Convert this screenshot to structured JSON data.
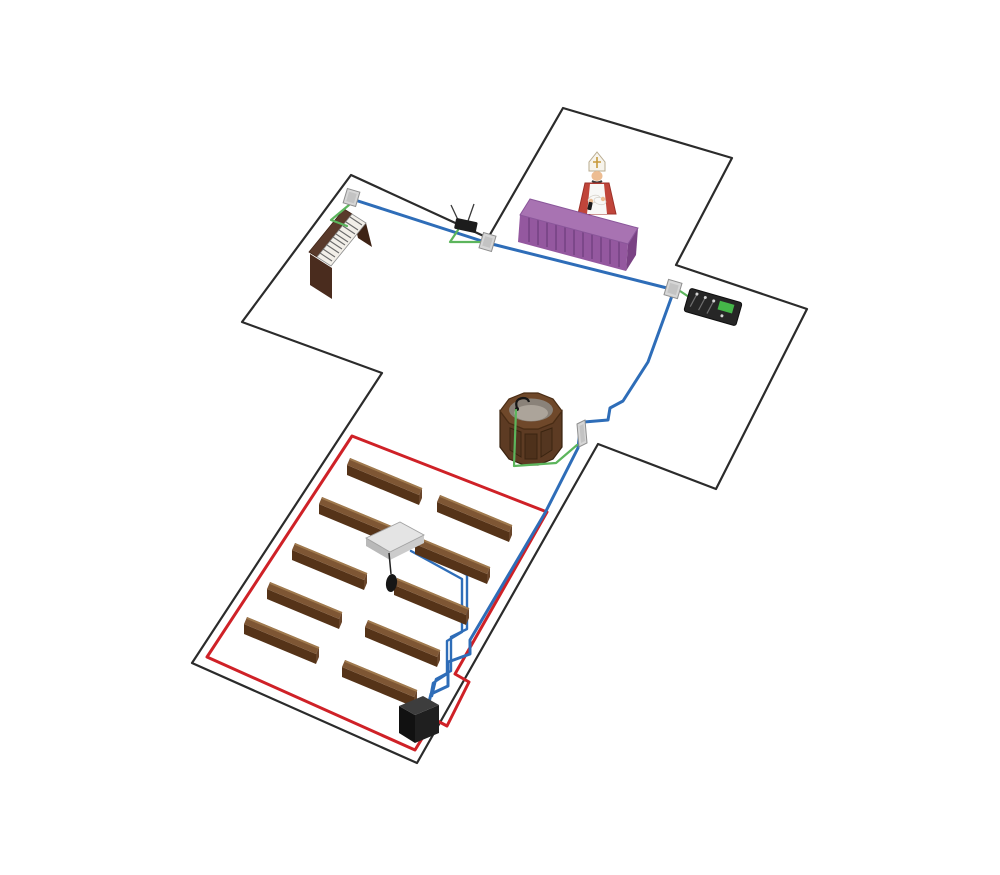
{
  "diagram": {
    "background": "#ffffff",
    "colors": {
      "outline": "#2b2b2b",
      "cable_blue": "#2e6db8",
      "cable_green": "#5cb55c",
      "loop_red": "#cf2127",
      "altar_purple": "#94589f",
      "altar_purple_top": "#a873b2",
      "wood_brown": "#7e5634",
      "wood_dark": "#553318",
      "plate_gray": "#d6d6d6",
      "device_black": "#1c1c1c",
      "amp_white": "#e4e4e4",
      "vestment_red": "#c0453a",
      "vestment_white": "#f8f8f6",
      "mixer_screen_green": "#45b649"
    },
    "components": [
      {
        "name": "church-floor-outline",
        "count": 1
      },
      {
        "name": "priest-figure",
        "count": 1
      },
      {
        "name": "altar-table",
        "count": 1
      },
      {
        "name": "organ",
        "count": 1
      },
      {
        "name": "wireless-receiver",
        "count": 1
      },
      {
        "name": "wall-plate",
        "count": 4
      },
      {
        "name": "mixer-console",
        "count": 1
      },
      {
        "name": "baptismal-font",
        "count": 1
      },
      {
        "name": "gooseneck-microphone",
        "count": 1
      },
      {
        "name": "pew",
        "count": 10
      },
      {
        "name": "loop-amplifier-box",
        "count": 1
      },
      {
        "name": "hanging-microphone",
        "count": 1
      },
      {
        "name": "loop-driver-unit",
        "count": 1
      },
      {
        "name": "induction-loop-cable",
        "count": 1
      },
      {
        "name": "audio-cable-run",
        "count": 3
      }
    ]
  }
}
